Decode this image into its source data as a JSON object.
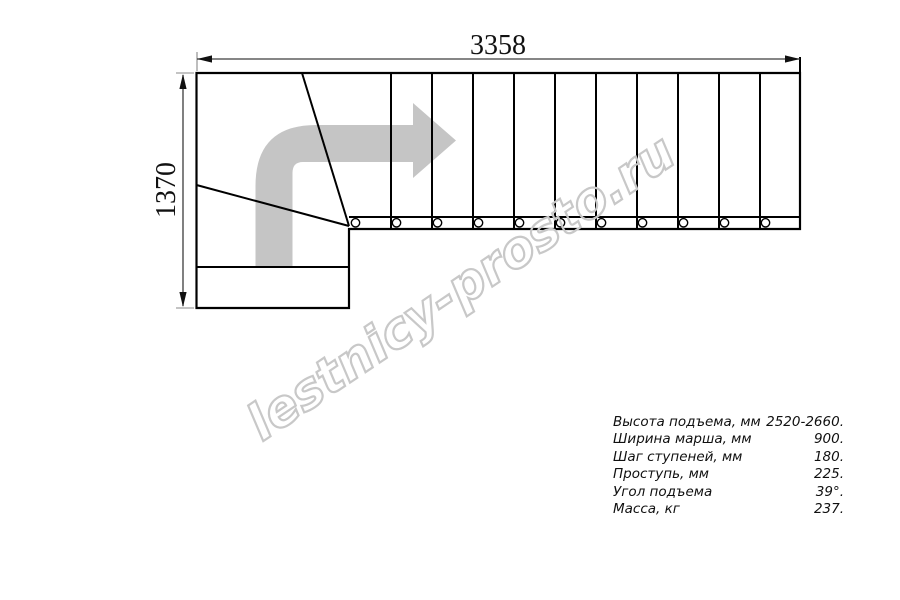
{
  "drawing": {
    "width_dimension": "3358",
    "height_dimension": "1370",
    "straight_tread_count": 11,
    "baluster_count": 11,
    "line_color": "#000000",
    "dimension_color": "#3d3d3d",
    "extension_color": "#888888",
    "arrow_color": "#c5c5c5"
  },
  "watermark": {
    "text": "lestnicy-prosto.ru",
    "color": "#c8c8c8"
  },
  "specs": {
    "rows": [
      {
        "label": "Высота подъема, мм",
        "value": "2520-2660."
      },
      {
        "label": "Ширина марша, мм",
        "value": "900."
      },
      {
        "label": "Шаг ступеней, мм",
        "value": "180."
      },
      {
        "label": "Проступь, мм",
        "value": "225."
      },
      {
        "label": "Угол подъема",
        "value": "39°."
      },
      {
        "label": "Масса, кг",
        "value": "237."
      }
    ]
  }
}
